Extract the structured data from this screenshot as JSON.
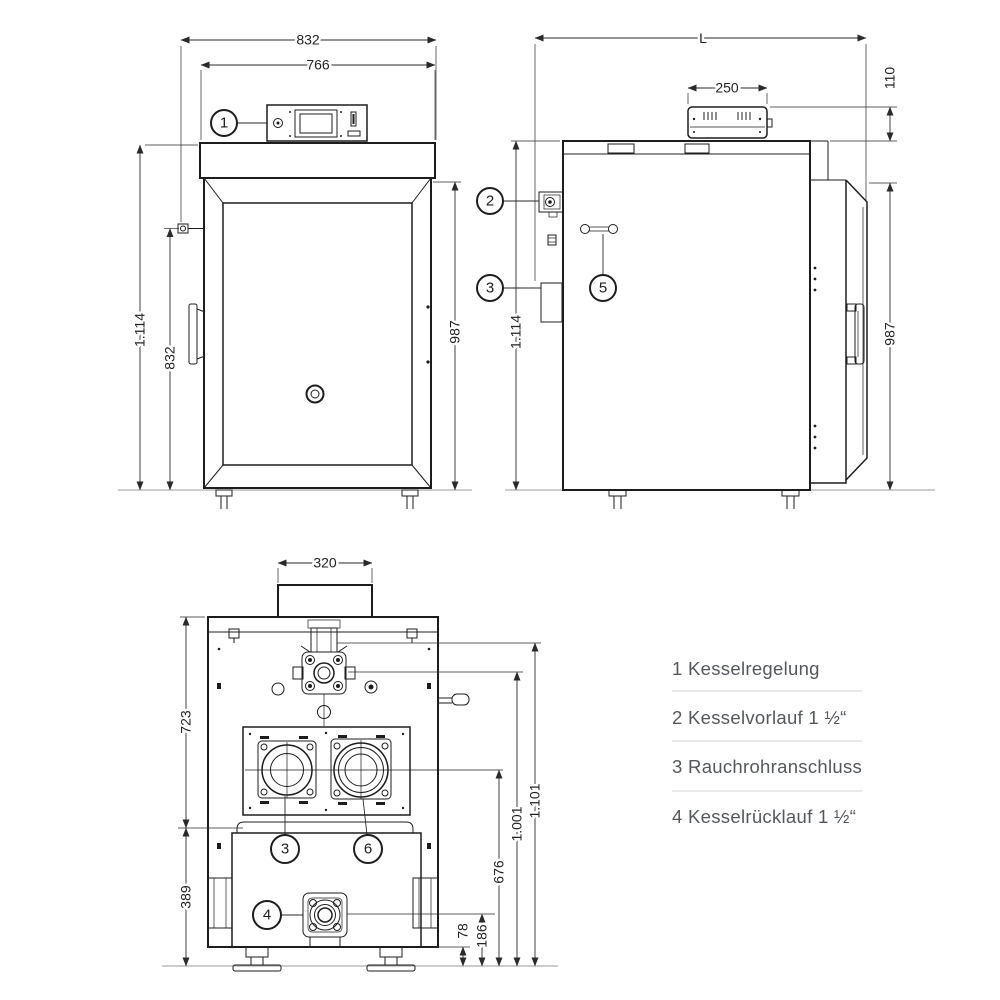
{
  "drawing": {
    "front": {
      "callout_control": "1",
      "dim_total_width": "832",
      "dim_body_width": "766",
      "dim_total_height": "1.114",
      "dim_fitting_height": "832",
      "dim_door_height": "987"
    },
    "side": {
      "callout_flow": "2",
      "callout_flue": "3",
      "callout_lever": "5",
      "dim_length": "L",
      "dim_panel_width": "250",
      "dim_panel_height": "110",
      "dim_total_height": "1.114",
      "dim_door_height": "987"
    },
    "rear": {
      "callout_flue": "3",
      "callout_cleanout": "6",
      "callout_return": "4",
      "dim_flue_width": "320",
      "dim_upper_height": "723",
      "dim_lower_height": "389",
      "dim_flue_center_height": "676",
      "dim_valve_height": "1.001",
      "dim_total_height": "1.101",
      "dim_base_height": "78",
      "dim_return_height": "186"
    }
  },
  "legend": {
    "items": [
      {
        "label": "1 Kesselregelung"
      },
      {
        "label": "2 Kesselvorlauf 1 ½“"
      },
      {
        "label": "3 Rauchrohranschluss"
      },
      {
        "label": "4 Kesselrücklauf 1 ½“"
      }
    ]
  },
  "colors": {
    "line": "#1d1d1f",
    "dimension": "#2a2a2c",
    "legend_text": "#54585d",
    "divider": "#d9d9d9",
    "background": "#ffffff"
  }
}
